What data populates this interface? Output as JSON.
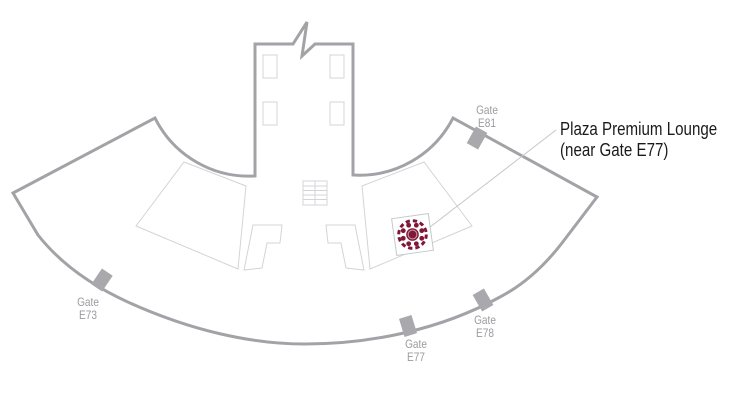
{
  "map": {
    "kind": "airport-concourse-floorplan",
    "concourse_shape": "curved-pier-fan",
    "callout": {
      "line1": "Plaza Premium Lounge",
      "line2": "(near Gate E77)"
    },
    "gates": [
      {
        "line1": "Gate",
        "line2": "E73"
      },
      {
        "line1": "Gate",
        "line2": "E77"
      },
      {
        "line1": "Gate",
        "line2": "E78"
      },
      {
        "line1": "Gate",
        "line2": "E81"
      }
    ],
    "icons": {
      "lounge_marker": "plaza-premium-lotus-logo",
      "stairs": "escalator-icon"
    }
  },
  "colors": {
    "outline": "#a3a3a7",
    "interior": "#d4d4d8",
    "marker": "#a9a9ad",
    "gate_text": "#9b9b9f",
    "callout_text": "#1a1a1a",
    "leader": "#c6c6ca",
    "logo": "#801737",
    "logo_frame": "#c2c9c9"
  }
}
